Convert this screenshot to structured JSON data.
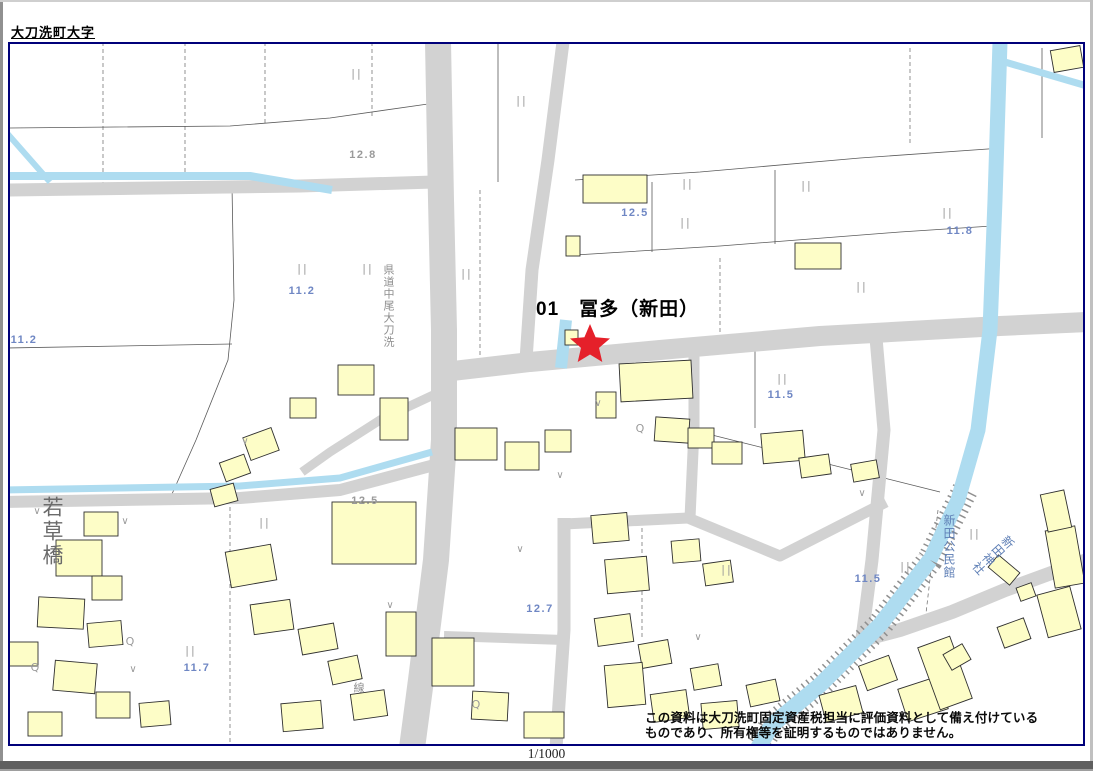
{
  "page": {
    "title": "大刀洗町大字",
    "scale_label": "1/1000",
    "disclaimer_line1": "この資料は大刀洗町固定資産税担当に評価資料として備え付けている",
    "disclaimer_line2": "ものであり、所有権等を証明するものではありません。"
  },
  "marker": {
    "number": "01",
    "name": "冨多（新田）",
    "label": "01　冨多（新田）",
    "symbol": "star",
    "color": "#e5202a"
  },
  "map": {
    "border_color": "#00007a",
    "colors": {
      "road": "#d2d2d2",
      "water": "#aedcf0",
      "building_fill": "#fdfdc7",
      "building_stroke": "#2f2f2f",
      "label_blue": "#6f87c4",
      "label_gray": "#9a9a9a",
      "symbol_gray": "#9a9a9a"
    },
    "place_labels": {
      "bridge": "若草橋",
      "route": "県道中尾大刀洗",
      "hall": "新田公民館",
      "shrine": "新田神社",
      "line_suffix": "線"
    },
    "elevation_labels": [
      {
        "text": "12.8",
        "x": 363,
        "y": 154,
        "color": "gray"
      },
      {
        "text": "11.2",
        "x": 302,
        "y": 290,
        "color": "blue"
      },
      {
        "text": "11.2",
        "x": 24,
        "y": 339,
        "color": "blue"
      },
      {
        "text": "12.5",
        "x": 635,
        "y": 212,
        "color": "blue"
      },
      {
        "text": "11.8",
        "x": 960,
        "y": 230,
        "color": "blue"
      },
      {
        "text": "11.5",
        "x": 781,
        "y": 394,
        "color": "blue"
      },
      {
        "text": "12.5",
        "x": 365,
        "y": 500,
        "color": "gray"
      },
      {
        "text": "12.7",
        "x": 540,
        "y": 608,
        "color": "blue"
      },
      {
        "text": "11.5",
        "x": 868,
        "y": 578,
        "color": "blue"
      },
      {
        "text": "11.7",
        "x": 197,
        "y": 667,
        "color": "blue"
      }
    ],
    "symbols": {
      "paddy_glyph": "||",
      "vee_glyph": "∨",
      "q_glyph": "Q",
      "paddy_positions": [
        [
          357,
          73
        ],
        [
          522,
          100
        ],
        [
          303,
          268
        ],
        [
          368,
          268
        ],
        [
          467,
          273
        ],
        [
          688,
          183
        ],
        [
          686,
          222
        ],
        [
          807,
          185
        ],
        [
          948,
          212
        ],
        [
          862,
          286
        ],
        [
          783,
          378
        ],
        [
          265,
          522
        ],
        [
          191,
          650
        ],
        [
          727,
          569
        ],
        [
          906,
          566
        ],
        [
          975,
          533
        ]
      ],
      "vee_positions": [
        [
          37,
          510
        ],
        [
          125,
          520
        ],
        [
          245,
          440
        ],
        [
          390,
          604
        ],
        [
          520,
          548
        ],
        [
          598,
          402
        ],
        [
          698,
          636
        ],
        [
          862,
          492
        ],
        [
          560,
          474
        ],
        [
          133,
          668
        ]
      ],
      "q_positions": [
        [
          640,
          428
        ],
        [
          130,
          641
        ],
        [
          35,
          667
        ],
        [
          476,
          704
        ]
      ]
    },
    "buildings": [
      [
        583,
        175,
        64,
        28,
        0
      ],
      [
        795,
        243,
        46,
        26,
        0
      ],
      [
        566,
        236,
        14,
        20,
        0
      ],
      [
        1052,
        48,
        30,
        22,
        -10
      ],
      [
        620,
        362,
        72,
        38,
        -3
      ],
      [
        596,
        392,
        20,
        26,
        0
      ],
      [
        565,
        330,
        13,
        15,
        0
      ],
      [
        455,
        428,
        42,
        32,
        0
      ],
      [
        505,
        442,
        34,
        28,
        0
      ],
      [
        545,
        430,
        26,
        22,
        0
      ],
      [
        655,
        418,
        34,
        24,
        4
      ],
      [
        688,
        428,
        26,
        20,
        0
      ],
      [
        712,
        442,
        30,
        22,
        0
      ],
      [
        762,
        432,
        42,
        30,
        -5
      ],
      [
        800,
        456,
        30,
        20,
        -8
      ],
      [
        852,
        462,
        26,
        18,
        -10
      ],
      [
        338,
        365,
        36,
        30,
        0
      ],
      [
        290,
        398,
        26,
        20,
        0
      ],
      [
        380,
        398,
        28,
        42,
        0
      ],
      [
        246,
        432,
        30,
        24,
        -20
      ],
      [
        222,
        458,
        26,
        20,
        -20
      ],
      [
        212,
        486,
        24,
        18,
        -15
      ],
      [
        332,
        502,
        84,
        62,
        0
      ],
      [
        84,
        512,
        34,
        24,
        0
      ],
      [
        56,
        540,
        46,
        36,
        0
      ],
      [
        92,
        576,
        30,
        24,
        0
      ],
      [
        38,
        598,
        46,
        30,
        3
      ],
      [
        88,
        622,
        34,
        24,
        -5
      ],
      [
        8,
        642,
        30,
        24,
        0
      ],
      [
        54,
        662,
        42,
        30,
        5
      ],
      [
        96,
        692,
        34,
        26,
        0
      ],
      [
        140,
        702,
        30,
        24,
        -5
      ],
      [
        28,
        712,
        34,
        24,
        0
      ],
      [
        228,
        548,
        46,
        36,
        -10
      ],
      [
        252,
        602,
        40,
        30,
        -8
      ],
      [
        300,
        626,
        36,
        26,
        -10
      ],
      [
        330,
        658,
        30,
        24,
        -12
      ],
      [
        352,
        692,
        34,
        26,
        -8
      ],
      [
        282,
        702,
        40,
        28,
        -5
      ],
      [
        432,
        638,
        42,
        48,
        0
      ],
      [
        472,
        692,
        36,
        28,
        3
      ],
      [
        524,
        712,
        40,
        26,
        0
      ],
      [
        386,
        612,
        30,
        44,
        0
      ],
      [
        592,
        514,
        36,
        28,
        -5
      ],
      [
        606,
        558,
        42,
        34,
        -5
      ],
      [
        596,
        616,
        36,
        28,
        -8
      ],
      [
        640,
        642,
        30,
        24,
        -10
      ],
      [
        606,
        664,
        38,
        42,
        -5
      ],
      [
        652,
        692,
        36,
        28,
        -8
      ],
      [
        692,
        666,
        28,
        22,
        -10
      ],
      [
        702,
        702,
        36,
        26,
        -5
      ],
      [
        748,
        682,
        30,
        22,
        -12
      ],
      [
        672,
        540,
        28,
        22,
        -5
      ],
      [
        704,
        562,
        28,
        22,
        -8
      ],
      [
        822,
        690,
        38,
        28,
        -15
      ],
      [
        862,
        660,
        32,
        26,
        -20
      ],
      [
        902,
        682,
        42,
        34,
        -18
      ],
      [
        928,
        640,
        34,
        66,
        -20
      ],
      [
        1000,
        622,
        28,
        22,
        -20
      ],
      [
        1042,
        590,
        34,
        44,
        -15
      ],
      [
        1050,
        528,
        30,
        58,
        -10
      ],
      [
        1044,
        492,
        24,
        38,
        -12
      ],
      [
        1018,
        585,
        16,
        14,
        -20
      ],
      [
        996,
        556,
        16,
        28,
        -50
      ],
      [
        946,
        648,
        22,
        18,
        -30
      ]
    ]
  }
}
